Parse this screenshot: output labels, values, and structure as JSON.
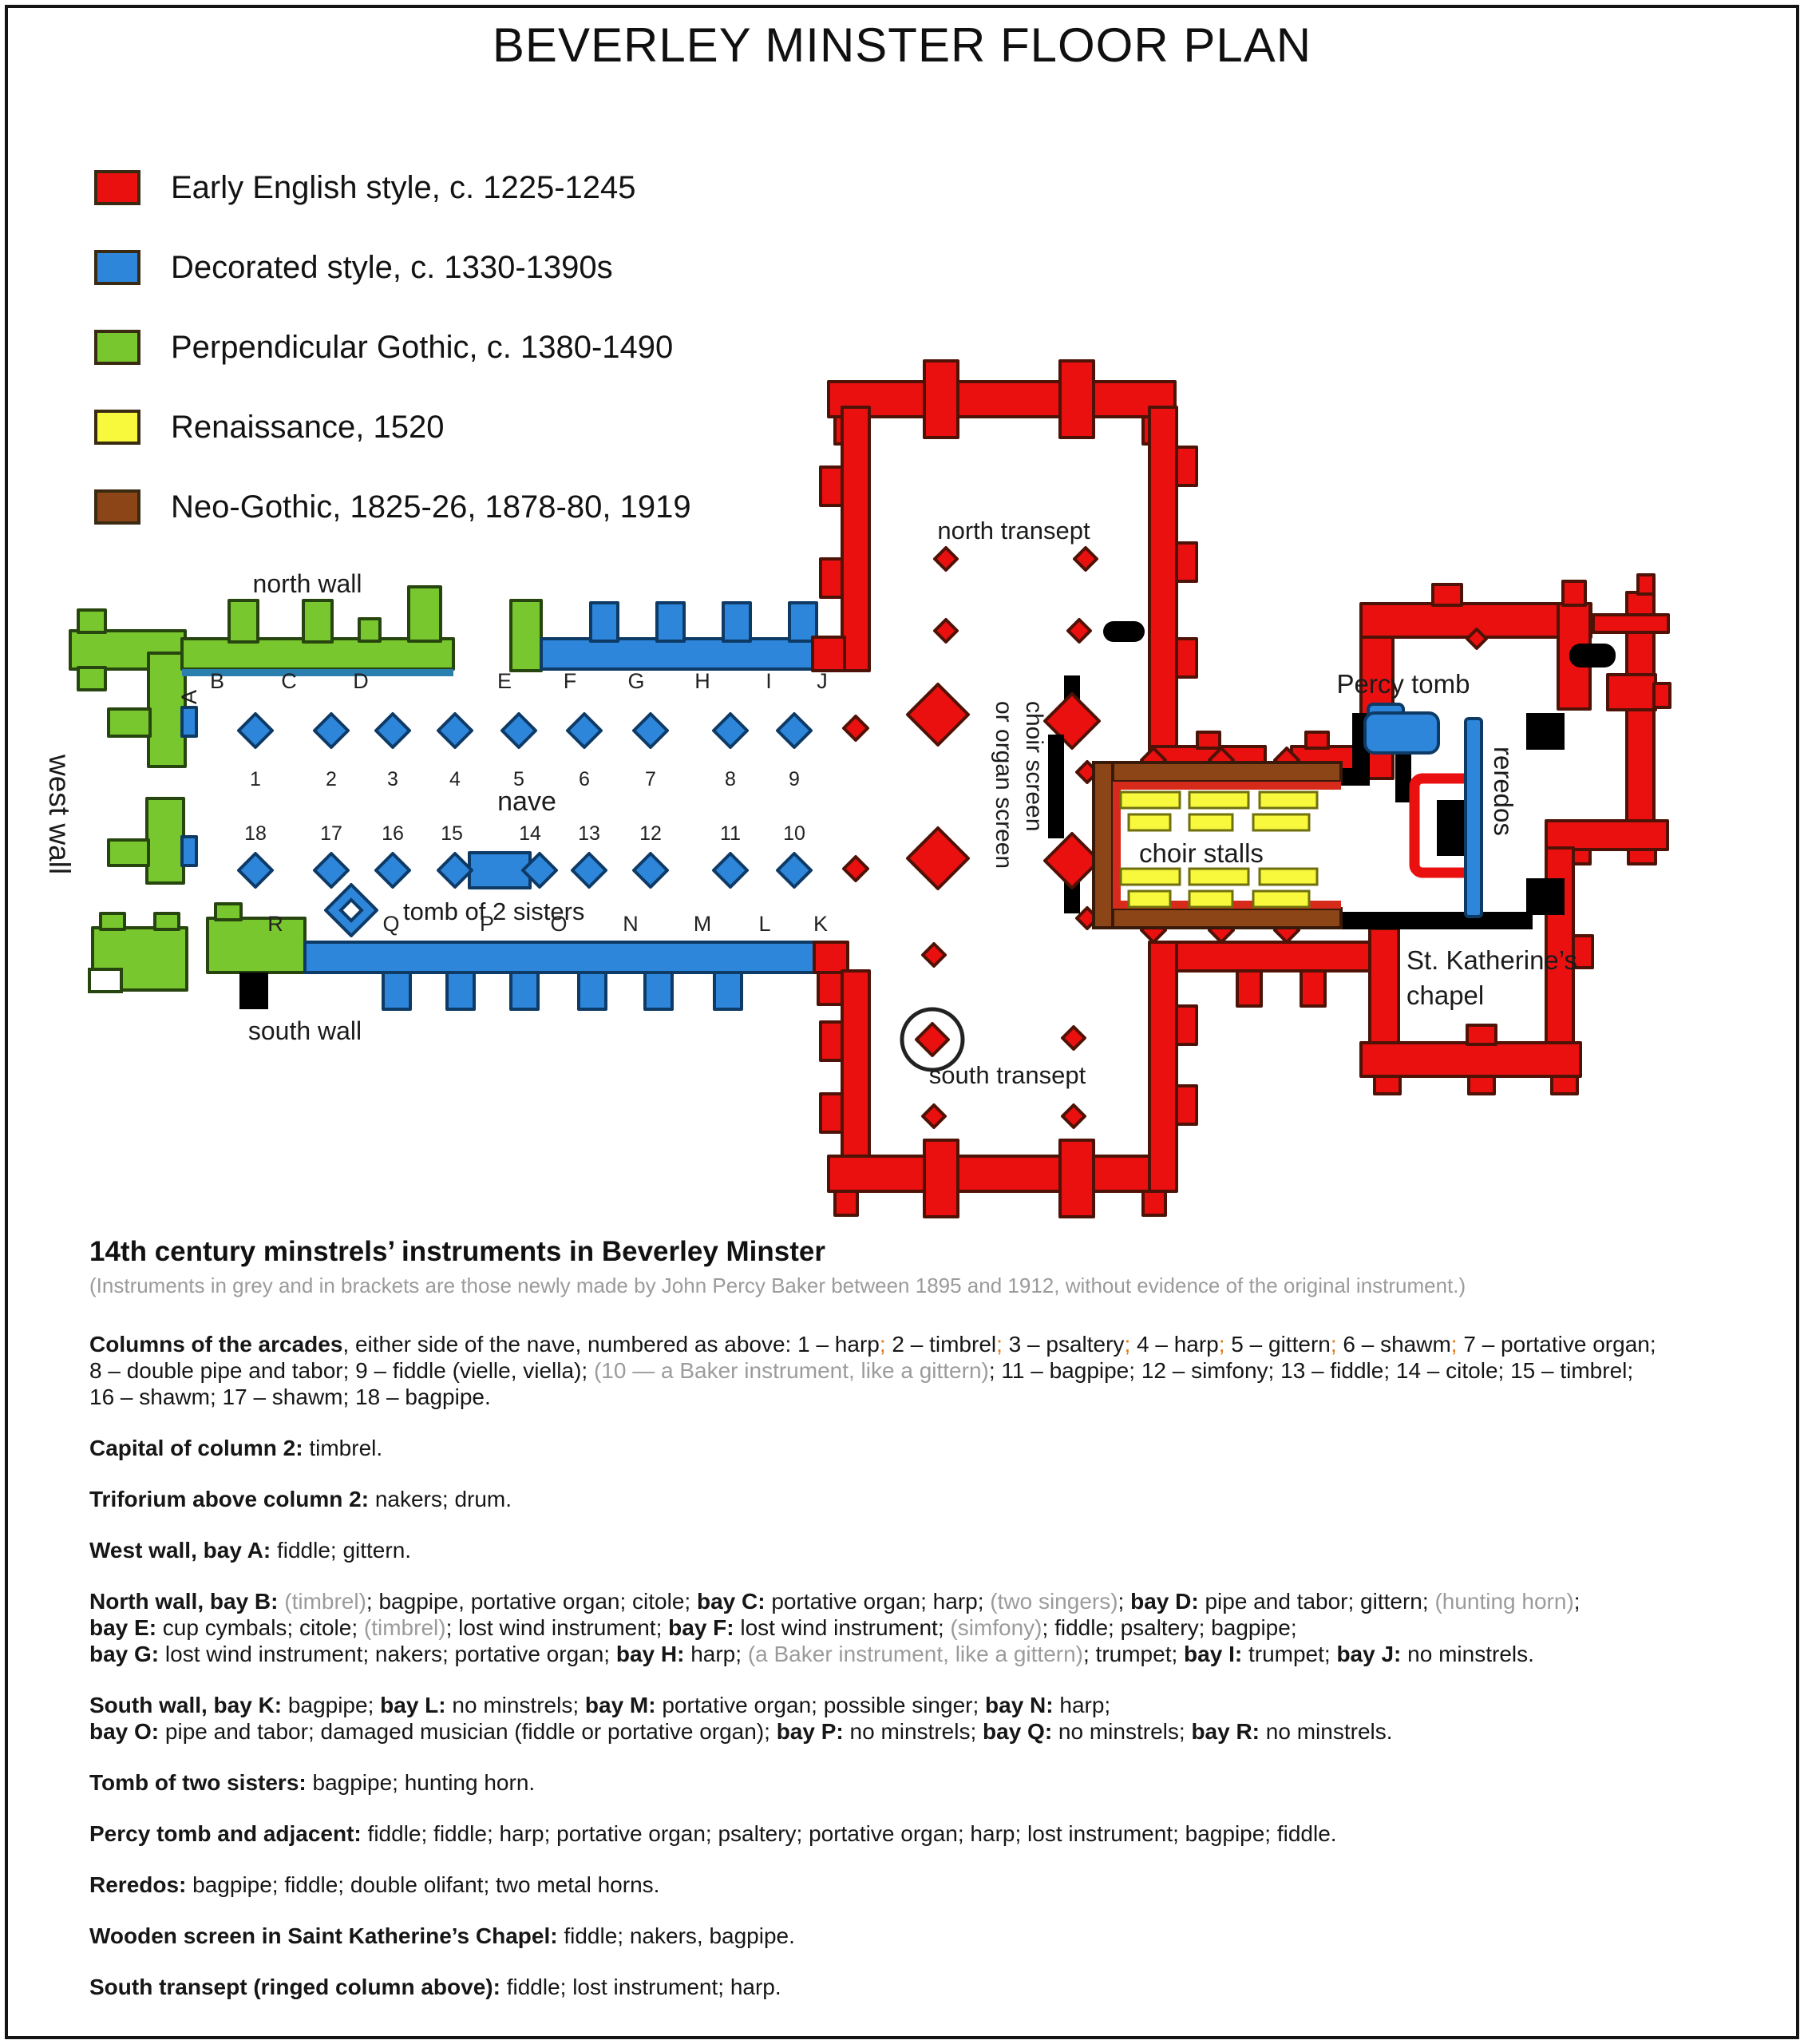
{
  "title": "BEVERLEY MINSTER FLOOR PLAN",
  "colors": {
    "early_english_red": "#EA1010",
    "decorated_blue": "#2E86DB",
    "perpendicular_green": "#79C72F",
    "renaissance_yellow": "#F8F83C",
    "neo_gothic_brown": "#8B4516"
  },
  "legend": [
    {
      "label": "Early English style, c. 1225-1245",
      "color": "#EA1010"
    },
    {
      "label": "Decorated style, c. 1330-1390s",
      "color": "#2E86DB"
    },
    {
      "label": "Perpendicular Gothic, c. 1380-1490",
      "color": "#79C72F"
    },
    {
      "label": "Renaissance, 1520",
      "color": "#F8F83C"
    },
    {
      "label": "Neo-Gothic, 1825-26, 1878-80, 1919",
      "color": "#8B4516"
    }
  ],
  "plan": {
    "labels": {
      "north_wall": "north wall",
      "south_wall": "south wall",
      "west_wall": "west wall",
      "nave": "nave",
      "north_transept": "north transept",
      "south_transept": "south transept",
      "tomb_of_2_sisters": "tomb of 2 sisters",
      "percy_tomb": "Percy tomb",
      "choir_stalls": "choir stalls",
      "choir_screen_line1": "choir screen",
      "choir_screen_line2": "or organ screen",
      "reredos": "reredos",
      "st_katherines_line1": "St. Katherine’s",
      "st_katherines_line2": "chapel"
    },
    "west_bay": "A",
    "north_bays": [
      "B",
      "C",
      "D",
      "E",
      "F",
      "G",
      "H",
      "I",
      "J"
    ],
    "south_bays": [
      "R",
      "Q",
      "P",
      "O",
      "N",
      "M",
      "L",
      "K"
    ],
    "top_columns": [
      "1",
      "2",
      "3",
      "4",
      "5",
      "6",
      "7",
      "8",
      "9"
    ],
    "bottom_columns": [
      "18",
      "17",
      "16",
      "15",
      "14",
      "13",
      "12",
      "11",
      "10"
    ]
  },
  "notes": {
    "heading": "14th century minstrels’ instruments in Beverley Minster",
    "subnote": "(Instruments in grey and in brackets are those newly made by John Percy Baker between 1895 and 1912, without evidence of the original instrument.)",
    "paragraphs": [
      {
        "lines": [
          [
            {
              "t": "Columns of the arcades",
              "s": "b"
            },
            {
              "t": ", either side of the nave, numbered as above: 1 – harp"
            },
            {
              "t": ";",
              "s": "o"
            },
            {
              "t": " 2 – timbrel"
            },
            {
              "t": ";",
              "s": "o"
            },
            {
              "t": " 3 – psaltery"
            },
            {
              "t": ";",
              "s": "o"
            },
            {
              "t": " 4 – harp"
            },
            {
              "t": ";",
              "s": "o"
            },
            {
              "t": " 5 – gittern"
            },
            {
              "t": ";",
              "s": "o"
            },
            {
              "t": " 6 – shawm"
            },
            {
              "t": ";",
              "s": "o"
            },
            {
              "t": " 7 – portative organ;"
            }
          ],
          [
            {
              "t": "8 – double pipe and tabor; 9 – fiddle (vielle, viella); "
            },
            {
              "t": "(10 — a Baker instrument, like a gittern)",
              "s": "g"
            },
            {
              "t": "; 11 – bagpipe; 12 – simfony; 13 – fiddle; 14 – citole; 15 – timbrel;"
            }
          ],
          [
            {
              "t": "16 – shawm; 17 – shawm; 18 – bagpipe."
            }
          ]
        ]
      },
      {
        "lines": [
          [
            {
              "t": "Capital of column 2:",
              "s": "b"
            },
            {
              "t": " timbrel."
            }
          ]
        ]
      },
      {
        "lines": [
          [
            {
              "t": "Triforium above column 2:",
              "s": "b"
            },
            {
              "t": " nakers; drum."
            }
          ]
        ]
      },
      {
        "lines": [
          [
            {
              "t": "West wall, bay A:",
              "s": "b"
            },
            {
              "t": " fiddle; gittern."
            }
          ]
        ]
      },
      {
        "lines": [
          [
            {
              "t": "North wall, bay B:",
              "s": "b"
            },
            {
              "t": " "
            },
            {
              "t": "(timbrel)",
              "s": "g"
            },
            {
              "t": "; bagpipe, portative organ; citole; "
            },
            {
              "t": "bay C:",
              "s": "b"
            },
            {
              "t": " portative organ; harp; "
            },
            {
              "t": "(two singers)",
              "s": "g"
            },
            {
              "t": "; "
            },
            {
              "t": "bay D:",
              "s": "b"
            },
            {
              "t": " pipe and tabor; gittern; "
            },
            {
              "t": "(hunting horn)",
              "s": "g"
            },
            {
              "t": ";"
            }
          ],
          [
            {
              "t": "bay E:",
              "s": "b"
            },
            {
              "t": " cup cymbals; citole; "
            },
            {
              "t": "(timbrel)",
              "s": "g"
            },
            {
              "t": "; lost wind instrument; "
            },
            {
              "t": "bay F:",
              "s": "b"
            },
            {
              "t": " lost wind instrument; "
            },
            {
              "t": "(simfony)",
              "s": "g"
            },
            {
              "t": "; fiddle; psaltery; bagpipe;"
            }
          ],
          [
            {
              "t": "bay G:",
              "s": "b"
            },
            {
              "t": " lost wind instrument; nakers; portative organ; "
            },
            {
              "t": "bay H:",
              "s": "b"
            },
            {
              "t": " harp; "
            },
            {
              "t": "(a Baker instrument, like a gittern)",
              "s": "g"
            },
            {
              "t": "; trumpet;  "
            },
            {
              "t": "bay I:",
              "s": "b"
            },
            {
              "t": " trumpet; "
            },
            {
              "t": "bay J:",
              "s": "b"
            },
            {
              "t": " no minstrels."
            }
          ]
        ]
      },
      {
        "lines": [
          [
            {
              "t": "South wall, bay K:",
              "s": "b"
            },
            {
              "t": " bagpipe; "
            },
            {
              "t": "bay L:",
              "s": "b"
            },
            {
              "t": " no minstrels; "
            },
            {
              "t": "bay M:",
              "s": "b"
            },
            {
              "t": " portative organ; possible singer; "
            },
            {
              "t": "bay N:",
              "s": "b"
            },
            {
              "t": " harp;"
            }
          ],
          [
            {
              "t": "bay O:",
              "s": "b"
            },
            {
              "t": " pipe and tabor; damaged musician (fiddle or portative organ); "
            },
            {
              "t": "bay P:",
              "s": "b"
            },
            {
              "t": " no minstrels; "
            },
            {
              "t": "bay Q:",
              "s": "b"
            },
            {
              "t": " no minstrels; "
            },
            {
              "t": "bay R:",
              "s": "b"
            },
            {
              "t": " no minstrels."
            }
          ]
        ]
      },
      {
        "lines": [
          [
            {
              "t": "Tomb of two sisters:",
              "s": "b"
            },
            {
              "t": " bagpipe; hunting horn."
            }
          ]
        ]
      },
      {
        "lines": [
          [
            {
              "t": "Percy tomb and adjacent:",
              "s": "b"
            },
            {
              "t": " fiddle; fiddle; harp; portative organ; psaltery; portative organ; harp; lost instrument; bagpipe; fiddle."
            }
          ]
        ]
      },
      {
        "lines": [
          [
            {
              "t": "Reredos:",
              "s": "b"
            },
            {
              "t": " bagpipe; fiddle; double olifant; two metal horns."
            }
          ]
        ]
      },
      {
        "lines": [
          [
            {
              "t": "Wooden screen in Saint Katherine’s Chapel:",
              "s": "b"
            },
            {
              "t": " fiddle; nakers, bagpipe."
            }
          ]
        ]
      },
      {
        "lines": [
          [
            {
              "t": "South transept (ringed column above):",
              "s": "b"
            },
            {
              "t": " fiddle; lost instrument; harp."
            }
          ]
        ]
      }
    ]
  }
}
